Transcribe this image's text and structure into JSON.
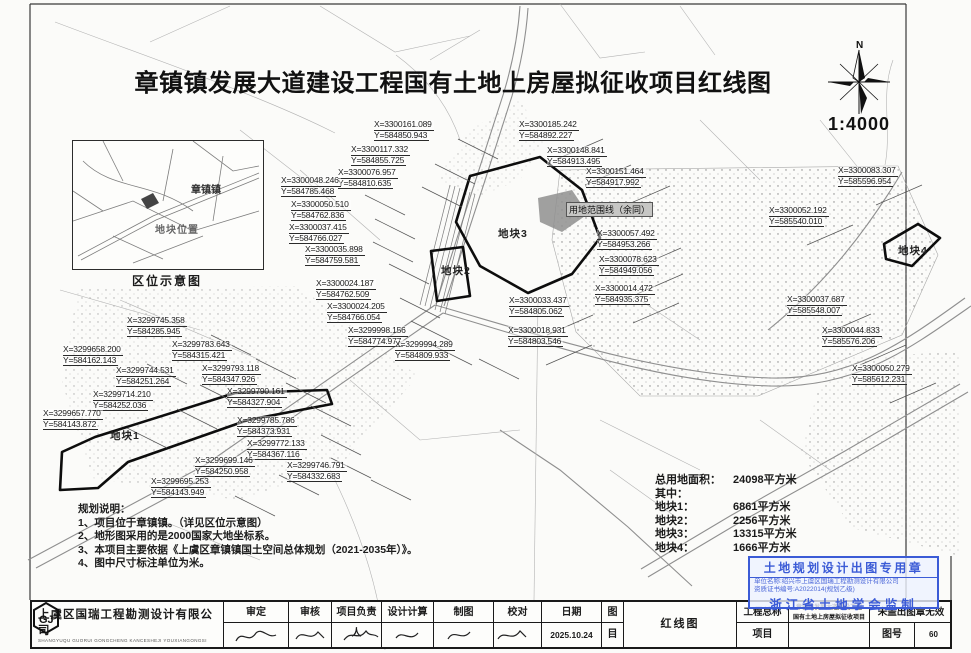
{
  "title": "章镇镇发展大道建设工程国有土地上房屋拟征收项目红线图",
  "scale": "1:4000",
  "north_label": "N",
  "inset": {
    "caption": "区位示意图",
    "town_label": "章镇镇",
    "site_label": "地块位置"
  },
  "map": {
    "boundary_label": "用地范围线（余同）",
    "plot_labels": [
      {
        "text": "地块1",
        "l": 110,
        "t": 428
      },
      {
        "text": "地块2",
        "l": 441,
        "t": 263
      },
      {
        "text": "地块3",
        "l": 498,
        "t": 226
      },
      {
        "text": "地块4",
        "l": 898,
        "t": 243
      }
    ],
    "coord_labels": [
      {
        "x": "X=3300161.089",
        "y": "Y=584850.943",
        "l": 374,
        "t": 120
      },
      {
        "x": "X=3300185.242",
        "y": "Y=584892.227",
        "l": 519,
        "t": 120
      },
      {
        "x": "X=3300117.332",
        "y": "Y=584855.725",
        "l": 351,
        "t": 145
      },
      {
        "x": "X=3300148.841",
        "y": "Y=584913.495",
        "l": 547,
        "t": 146
      },
      {
        "x": "X=3300076.957",
        "y": "Y=584810.635",
        "l": 338,
        "t": 168
      },
      {
        "x": "X=3300048.246",
        "y": "Y=584785.468",
        "l": 281,
        "t": 176
      },
      {
        "x": "X=3300151.464",
        "y": "Y=584917.992",
        "l": 586,
        "t": 167
      },
      {
        "x": "X=3300083.307",
        "y": "Y=585596.954",
        "l": 838,
        "t": 166
      },
      {
        "x": "X=3300050.510",
        "y": "Y=584762.836",
        "l": 291,
        "t": 200
      },
      {
        "x": "X=3300052.192",
        "y": "Y=585540.010",
        "l": 769,
        "t": 206
      },
      {
        "x": "X=3300037.415",
        "y": "Y=584766.027",
        "l": 289,
        "t": 223
      },
      {
        "x": "X=3300057.492",
        "y": "Y=584953.266",
        "l": 597,
        "t": 229
      },
      {
        "x": "X=3300035.898",
        "y": "Y=584759.581",
        "l": 305,
        "t": 245
      },
      {
        "x": "X=3300078.623",
        "y": "Y=584949.056",
        "l": 599,
        "t": 255
      },
      {
        "x": "X=3300024.187",
        "y": "Y=584762.509",
        "l": 316,
        "t": 279
      },
      {
        "x": "X=3300014.472",
        "y": "Y=584935.375",
        "l": 595,
        "t": 284
      },
      {
        "x": "X=3300024.205",
        "y": "Y=584766.054",
        "l": 327,
        "t": 302
      },
      {
        "x": "X=3300033.437",
        "y": "Y=584805.062",
        "l": 509,
        "t": 296
      },
      {
        "x": "X=3300037.687",
        "y": "Y=585548.007",
        "l": 787,
        "t": 295
      },
      {
        "x": "X=3299998.156",
        "y": "Y=584774.977",
        "l": 348,
        "t": 326
      },
      {
        "x": "X=3300018.931",
        "y": "Y=584803.546",
        "l": 508,
        "t": 326
      },
      {
        "x": "X=3299994.289",
        "y": "Y=584809.933",
        "l": 395,
        "t": 340
      },
      {
        "x": "X=3300044.833",
        "y": "Y=585576.206",
        "l": 822,
        "t": 326
      },
      {
        "x": "X=3300050.279",
        "y": "Y=585612.231",
        "l": 852,
        "t": 364
      },
      {
        "x": "X=3299745.358",
        "y": "Y=584285.945",
        "l": 127,
        "t": 316
      },
      {
        "x": "X=3299658.200",
        "y": "Y=584162.143",
        "l": 63,
        "t": 345
      },
      {
        "x": "X=3299783.643",
        "y": "Y=584315.421",
        "l": 172,
        "t": 340
      },
      {
        "x": "X=3299744.531",
        "y": "Y=584251.264",
        "l": 116,
        "t": 366
      },
      {
        "x": "X=3299793.118",
        "y": "Y=584347.926",
        "l": 202,
        "t": 364
      },
      {
        "x": "X=3299714.210",
        "y": "Y=584252.036",
        "l": 93,
        "t": 390
      },
      {
        "x": "X=3299790.161",
        "y": "Y=584327.904",
        "l": 227,
        "t": 387
      },
      {
        "x": "X=3299657.770",
        "y": "Y=584143.872",
        "l": 43,
        "t": 409
      },
      {
        "x": "X=3299785.786",
        "y": "Y=584373.931",
        "l": 237,
        "t": 416
      },
      {
        "x": "X=3299772.133",
        "y": "Y=584367.116",
        "l": 247,
        "t": 439
      },
      {
        "x": "X=3299699.146",
        "y": "Y=584250.958",
        "l": 195,
        "t": 456
      },
      {
        "x": "X=3299746.791",
        "y": "Y=584332.683",
        "l": 287,
        "t": 461
      },
      {
        "x": "X=3299695.253",
        "y": "Y=584143.949",
        "l": 151,
        "t": 477
      }
    ]
  },
  "stats": {
    "rows": [
      {
        "label": "总用地面积：",
        "value": "24098平方米"
      },
      {
        "label": "其中：",
        "value": ""
      },
      {
        "label": "地块1：",
        "value": "6861平方米"
      },
      {
        "label": "地块2：",
        "value": "2256平方米"
      },
      {
        "label": "地块3：",
        "value": "13315平方米"
      },
      {
        "label": "地块4：",
        "value": "1666平方米"
      }
    ]
  },
  "notes": {
    "title": "规划说明：",
    "items": [
      "1、项目位于章镇镇。（详见区位示意图）",
      "2、地形图采用的是2000国家大地坐标系。",
      "3、本项目主要依据《上虞区章镇镇国土空间总体规划（2021-2035年）》。",
      "4、图中尺寸标注单位为米。"
    ]
  },
  "stamp": {
    "line1": "土地规划设计出图专用章",
    "line2": "单位名称:绍兴市上虞区国瑞工程勘测设计有限公司",
    "line3": "资质证书编号:A2022014(规划乙级)",
    "line4": "浙江省土地学会监制",
    "color": "#3b5bd6"
  },
  "titleblock": {
    "company": "上虞区国瑞工程勘测设计有限公司",
    "company_sub": "SHANGYUQU GUORUI GONGCHENG KANCESHEJI YOUXIANGONGSI",
    "logo_text": "GJ",
    "sign_cols": [
      {
        "label": "审定",
        "w": 65
      },
      {
        "label": "审核",
        "w": 43
      },
      {
        "label": "项目负责人",
        "w": 50
      },
      {
        "label": "设计计算",
        "w": 52
      },
      {
        "label": "制图",
        "w": 60
      },
      {
        "label": "校对",
        "w": 48
      }
    ],
    "date_label": "日期",
    "date_value": "2025.10.24",
    "sheet_cat_top": "图",
    "sheet_cat_bottom": "目",
    "drawing_name": "红线图",
    "project_label": "工程总称",
    "item_label": "项目",
    "project_name_line1": "章镇镇发展大道建设工程",
    "project_name_line2": "国有土地上房屋拟征收项目",
    "no_stamp_notice": "未盖出图章无效",
    "sheet_no_label": "图号",
    "sheet_no_value": "60"
  }
}
